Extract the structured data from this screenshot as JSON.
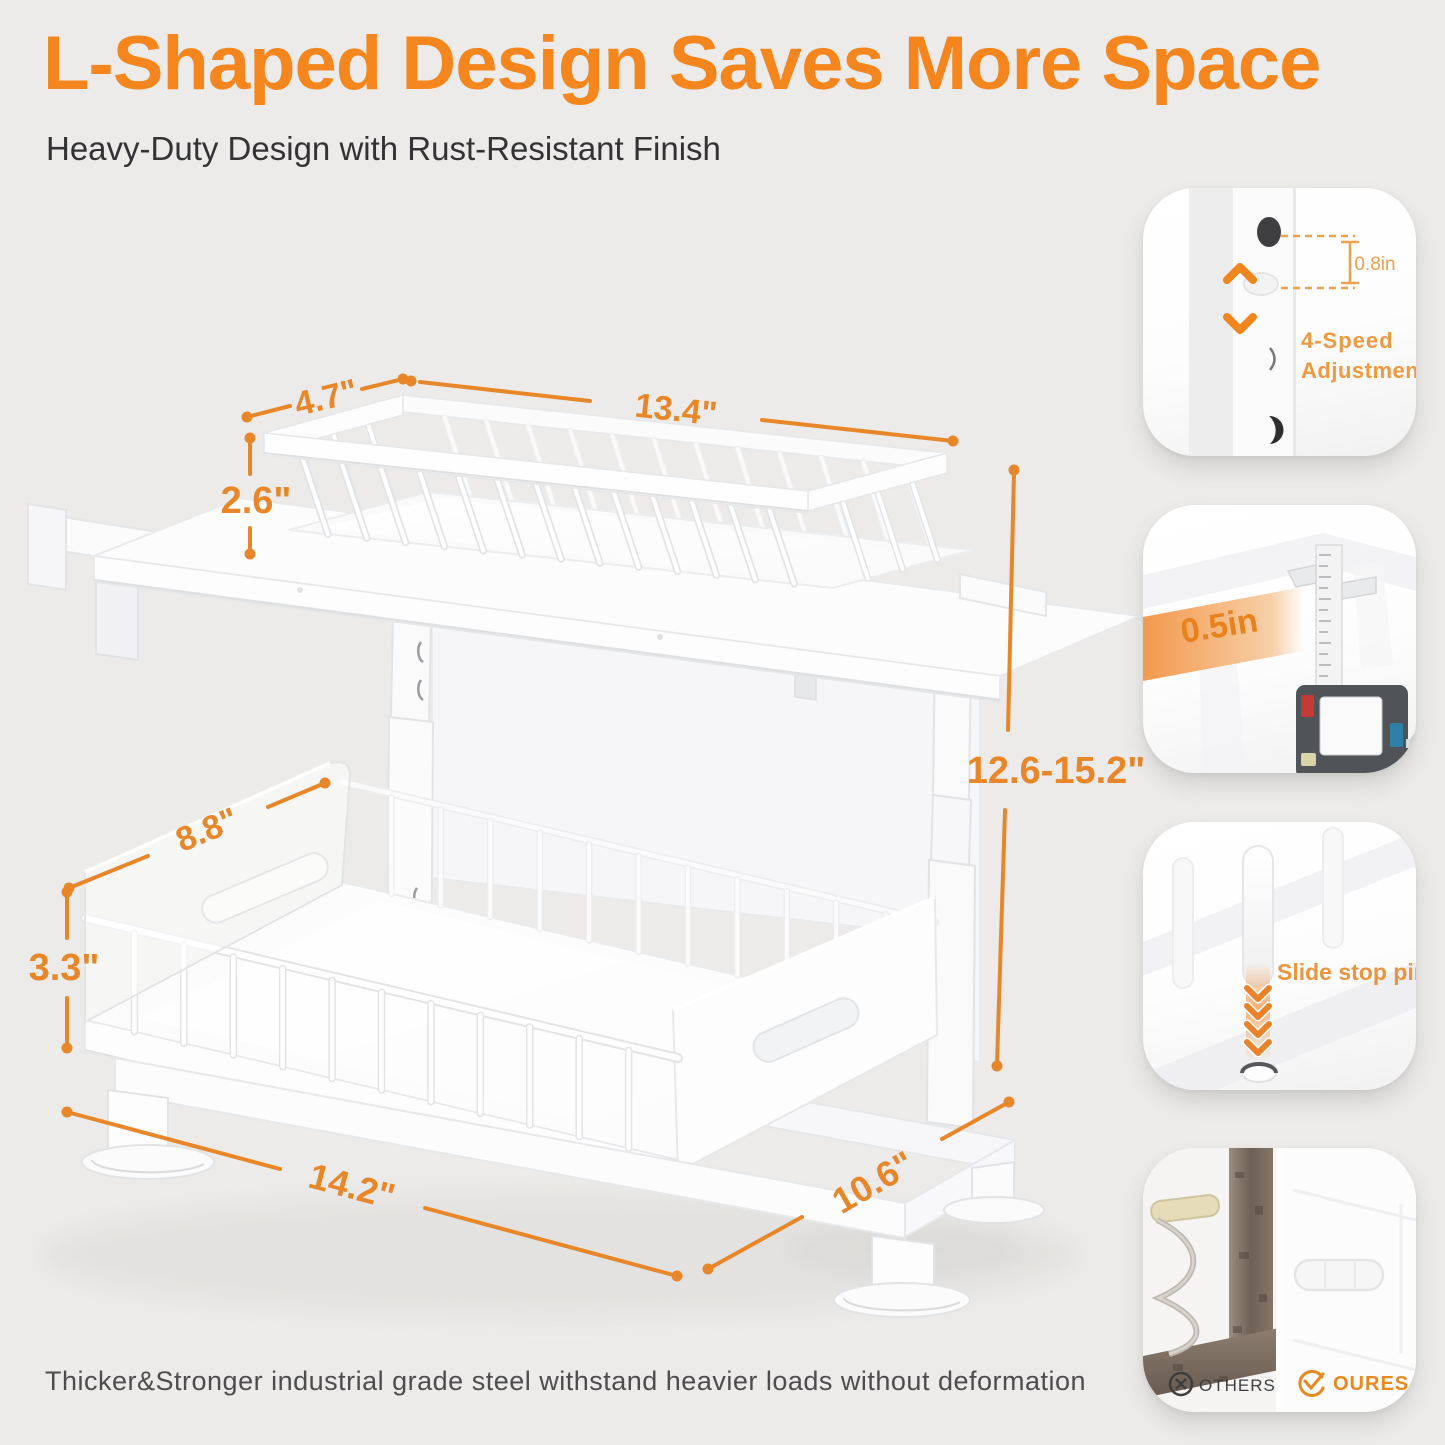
{
  "colors": {
    "accent_title": "#F5861D",
    "dimension_orange": "#E8872A",
    "callout_orange": "#EF9A40"
  },
  "header": {
    "title": "L-Shaped Design Saves More Space",
    "subtitle": "Heavy-Duty Design with Rust-Resistant Finish"
  },
  "footer": {
    "note": "Thicker&Stronger industrial grade steel withstand heavier loads without deformation"
  },
  "dims": {
    "top_depth": "4.7\"",
    "top_width": "13.4\"",
    "top_height": "2.6\"",
    "drawer_depth": "8.8\"",
    "drawer_height": "3.3\"",
    "base_width": "14.2\"",
    "base_depth": "10.6\"",
    "height_range": "12.6-15.2\""
  },
  "callouts": {
    "adjustment": {
      "measure": "0.8in",
      "line1": "4-Speed",
      "line2": "Adjustment"
    },
    "thickness": {
      "measure": "0.5in"
    },
    "slide": {
      "label": "Slide stop pin"
    },
    "comparison": {
      "others": "OTHERS",
      "ours": "OURES"
    }
  }
}
